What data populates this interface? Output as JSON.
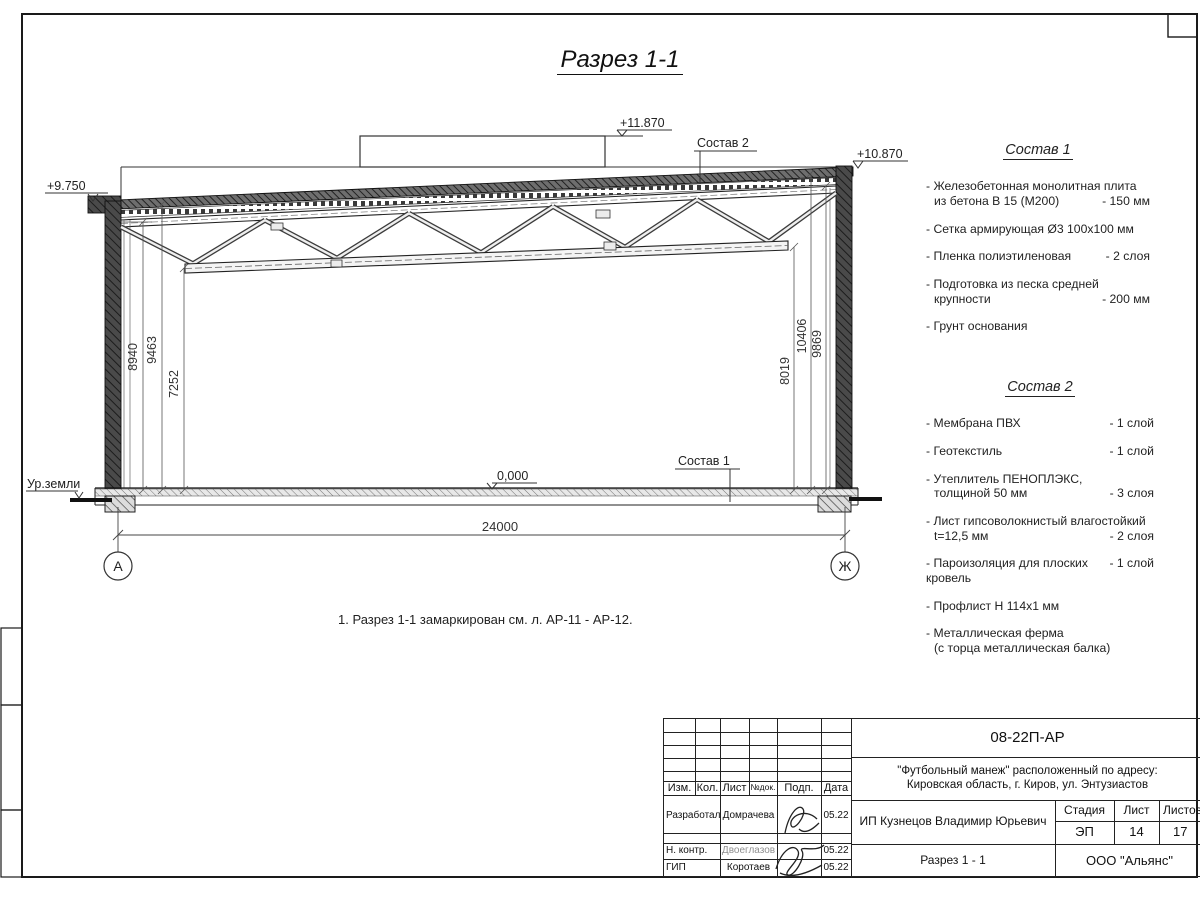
{
  "page": {
    "title": "Разрез 1-1",
    "note": "1. Разрез 1-1 замаркирован см. л. АР-11 - АР-12."
  },
  "drawing": {
    "elev_top": "+11.870",
    "elev_right": "+10.870",
    "elev_left": "+9.750",
    "elev_floor": "0,000",
    "ground_label": "Ур.земли",
    "comp1_label": "Состав 1",
    "comp2_label": "Состав 2",
    "dim_left_1": "8940",
    "dim_left_2": "9463",
    "dim_left_3": "7252",
    "dim_right_1": "8019",
    "dim_right_2": "10406",
    "dim_right_3": "9869",
    "dim_span": "24000",
    "axis_left": "А",
    "axis_right": "Ж"
  },
  "comp1": {
    "title": "Состав 1",
    "items": {
      "i1": {
        "l1": "- Железобетонная  монолитная плита",
        "l2": "из бетона В 15 (М200)",
        "v2": "- 150 мм"
      },
      "i2": {
        "l1": "- Сетка армирующая Ø3 100х100 мм"
      },
      "i3": {
        "l1": "- Пленка полиэтиленовая",
        "v1": "-  2 слоя"
      },
      "i4": {
        "l1": "- Подготовка из песка средней",
        "l2": "крупности",
        "v2": "- 200 мм"
      },
      "i5": {
        "l1": "- Грунт основания"
      }
    }
  },
  "comp2": {
    "title": "Состав 2",
    "items": {
      "i1": {
        "l1": "- Мембрана ПВХ",
        "v1": "- 1 слой"
      },
      "i2": {
        "l1": "- Геотекстиль",
        "v1": "- 1 слой"
      },
      "i3": {
        "l1": "- Утеплитель ПЕНОПЛЭКС,",
        "l2": "толщиной 50 мм",
        "v2": "- 3 слоя"
      },
      "i4": {
        "l1": "- Лист гипсоволокнистый влагостойкий",
        "l2": "t=12,5 мм",
        "v2": "- 2 слоя"
      },
      "i5": {
        "l1": "- Пароизоляция для плоских кровель",
        "v1": "- 1 слой"
      },
      "i6": {
        "l1": "- Профлист Н 114х1 мм"
      },
      "i7": {
        "l1": "- Металлическая ферма",
        "l2": "(с торца металлическая балка)"
      }
    }
  },
  "tb": {
    "doc_number": "08-22П-АР",
    "project_line1": "\"Футбольный манеж\" расположенный по адресу:",
    "project_line2": "Кировская область, г. Киров, ул. Энтузиастов",
    "h_izm": "Изм.",
    "h_kol": "Кол.",
    "h_list": "Лист",
    "h_ndok": "№док.",
    "h_podp": "Подп.",
    "h_data": "Дата",
    "r1_role": "Разработал",
    "r1_name": "Домрачева",
    "r1_date": "05.22",
    "r2_role": "Н. контр.",
    "r2_name": "Двоеглазов",
    "r2_date": "05.22",
    "r3_role": "ГИП",
    "r3_name": "Коротаев",
    "r3_date": "05.22",
    "client": "ИП Кузнецов Владимир Юрьевич",
    "stage_label": "Стадия",
    "sheet_label": "Лист",
    "sheets_label": "Листов",
    "stage": "ЭП",
    "sheet": "14",
    "sheets": "17",
    "drawing_title": "Разрез 1 - 1",
    "company": "ООО \"Альянс\""
  }
}
